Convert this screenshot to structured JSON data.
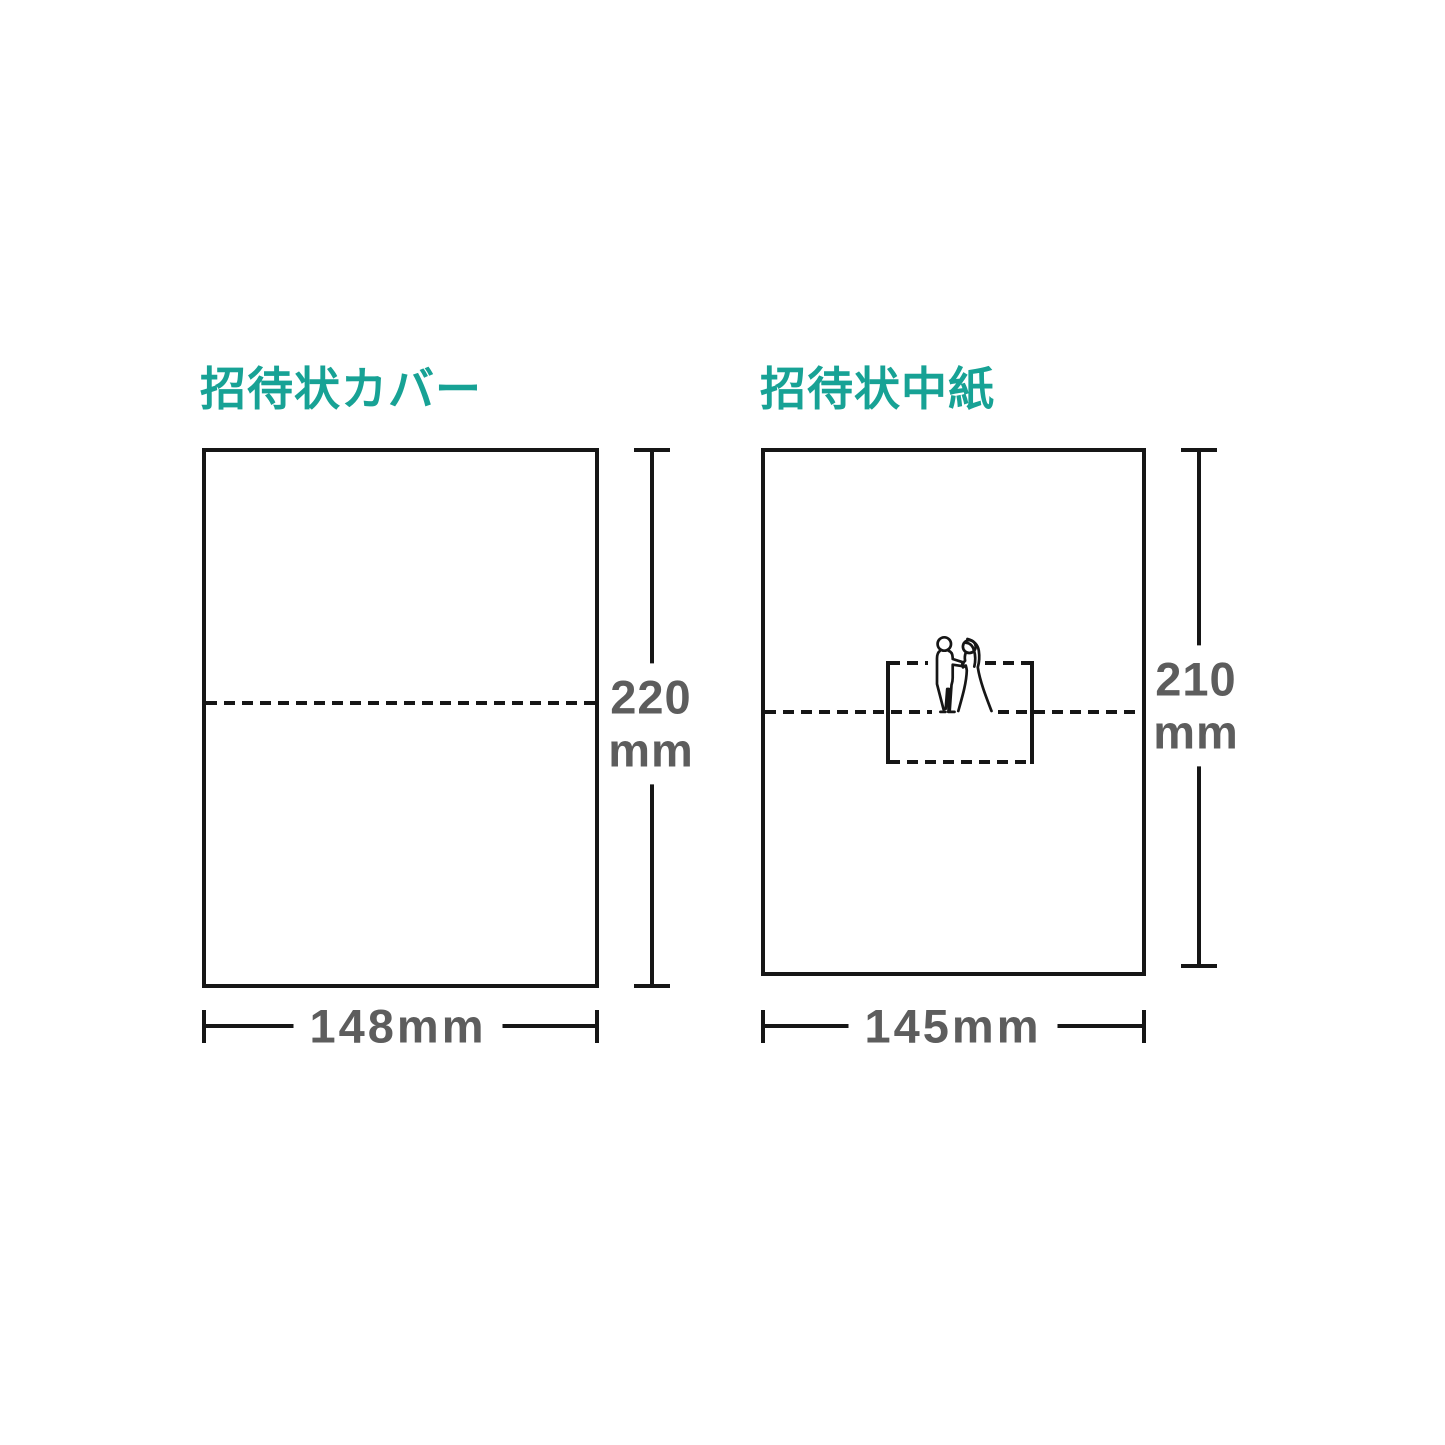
{
  "theme": {
    "accent": "#17a295",
    "ink": "#161616",
    "muted": "#5d5d5d",
    "bg": "#ffffff"
  },
  "cover": {
    "title": "招待状カバー",
    "height_value": "220",
    "height_unit": "mm",
    "width_label": "148mm"
  },
  "insert": {
    "title": "招待状中紙",
    "height_value": "210",
    "height_unit": "mm",
    "width_label": "145mm"
  },
  "icons": {
    "couple": "bride-groom-icon"
  }
}
